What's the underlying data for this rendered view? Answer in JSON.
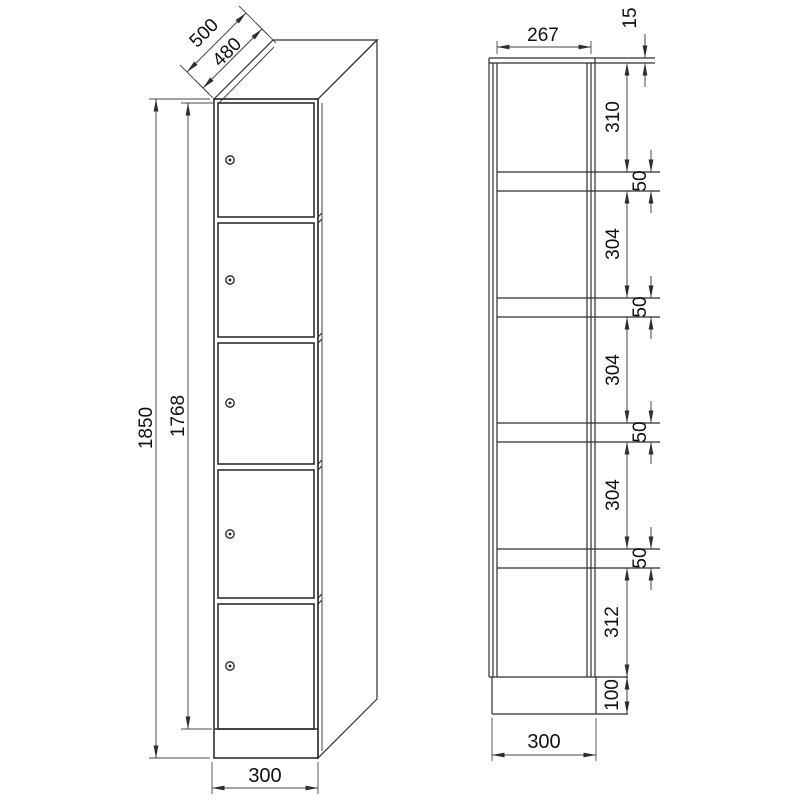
{
  "page": {
    "background": "#ffffff",
    "line_color": "#2e2e2e",
    "text_color": "#111111",
    "description": "Technical dimension drawing of a single-column 5-compartment locker cabinet"
  },
  "front_view": {
    "name": "locker-front-perspective",
    "door_count": 5,
    "dims": {
      "depth_outer": "500",
      "depth_body": "480",
      "height_total": "1850",
      "height_doors": "1768",
      "width_front": "300"
    }
  },
  "section_view": {
    "name": "locker-vertical-section",
    "dims": {
      "inner_width": "267",
      "top_panel": "15",
      "compartment_1": "310",
      "shelf_1": "50",
      "compartment_2": "304",
      "shelf_2": "50",
      "compartment_3": "304",
      "shelf_3": "50",
      "compartment_4": "304",
      "shelf_4": "50",
      "compartment_5": "312",
      "plinth": "100",
      "width": "300"
    }
  }
}
